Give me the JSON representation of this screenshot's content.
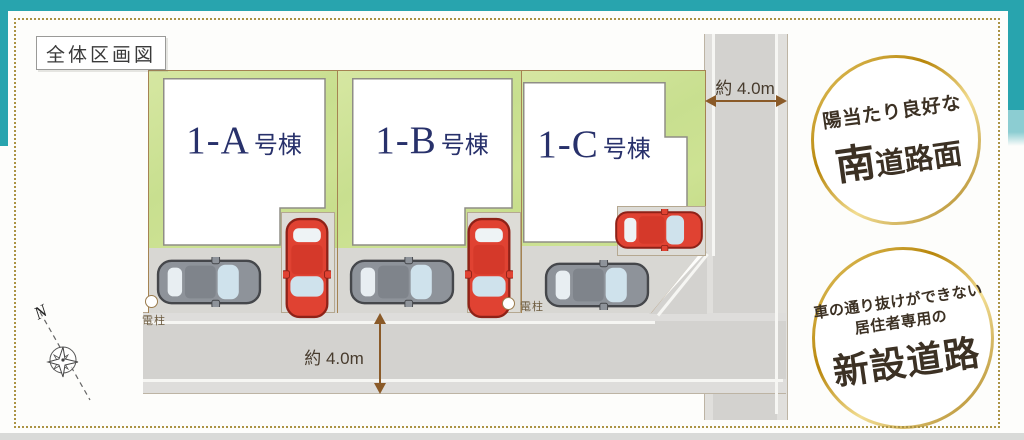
{
  "frame": {
    "title_label": "全体区画図"
  },
  "plan": {
    "lots": [
      {
        "name_main": "1-A",
        "name_suffix": "号棟"
      },
      {
        "name_main": "1-B",
        "name_suffix": "号棟"
      },
      {
        "name_main": "1-C",
        "name_suffix": "号棟"
      }
    ],
    "dimensions": {
      "vertical_road_width": "約 4.0m",
      "horizontal_road_width": "約 4.0m"
    },
    "utility_pole_label": "電柱",
    "compass_north_label": "N"
  },
  "badges": {
    "south_road": {
      "line1": "陽当たり良好な",
      "emphasis": "南",
      "rest": "道路面"
    },
    "new_road": {
      "line1": "車の通り抜けができない",
      "line2": "居住者専用の",
      "emphasis": "新設道路"
    }
  },
  "colors": {
    "teal_border": "#28a4ae",
    "gold_dotted_frame": "#ab9344",
    "badge_ring_gold": "#c9a437",
    "lot_green": "#cadf92",
    "road_gray": "#d3d2cf",
    "house_white": "#ffffff",
    "lot_label_navy": "#28316b",
    "dimension_brown": "#8a5a28",
    "car_red": "#e04232",
    "car_gray": "#8e939a"
  }
}
